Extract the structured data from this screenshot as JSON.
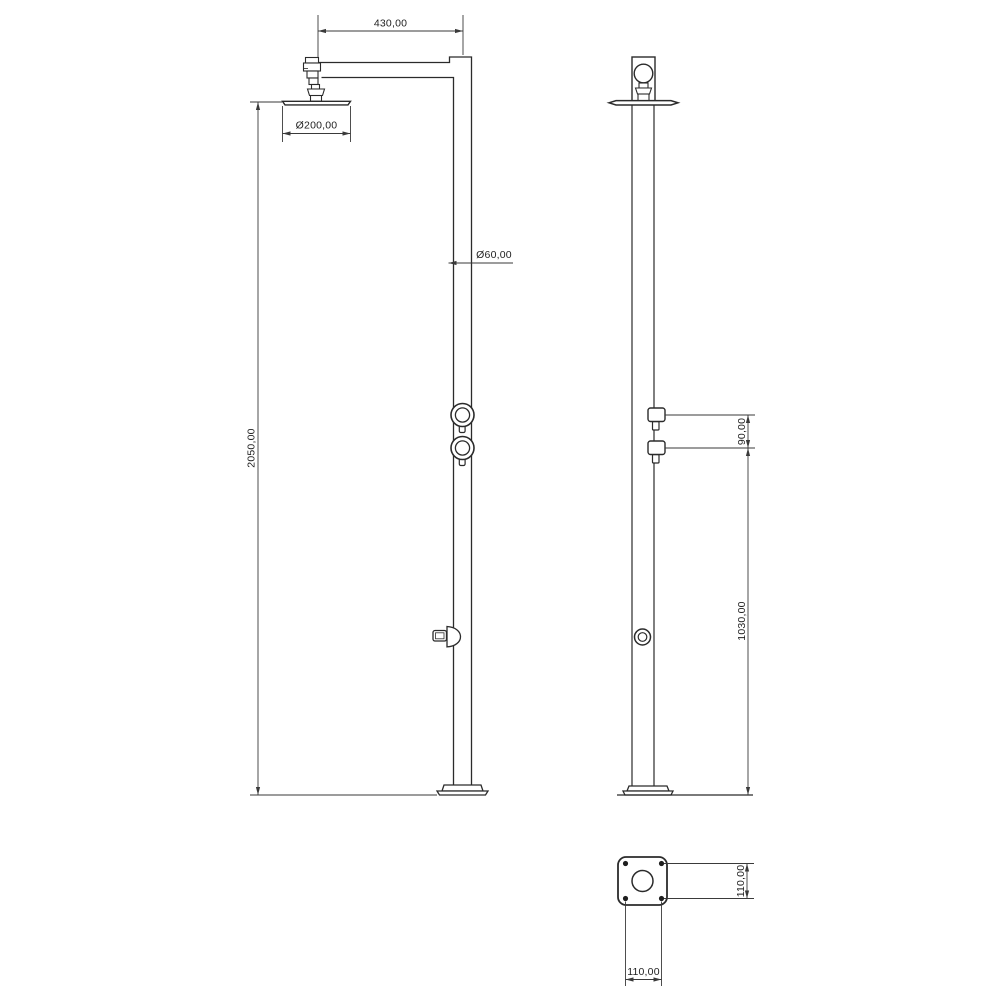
{
  "drawing": {
    "colors": {
      "line": "#2b2b2b",
      "dimension_line": "#3a3a3a",
      "text": "#1f1f1f",
      "background": "#ffffff"
    },
    "dimensions": {
      "arm_length": "430,00",
      "head_diameter": "Ø200,00",
      "pole_diameter": "Ø60,00",
      "total_height": "2050,00",
      "handle_spacing": "90,00",
      "tap_height": "1030,00",
      "base_plate_depth": "110,00",
      "base_plate_width": "110,00"
    }
  }
}
